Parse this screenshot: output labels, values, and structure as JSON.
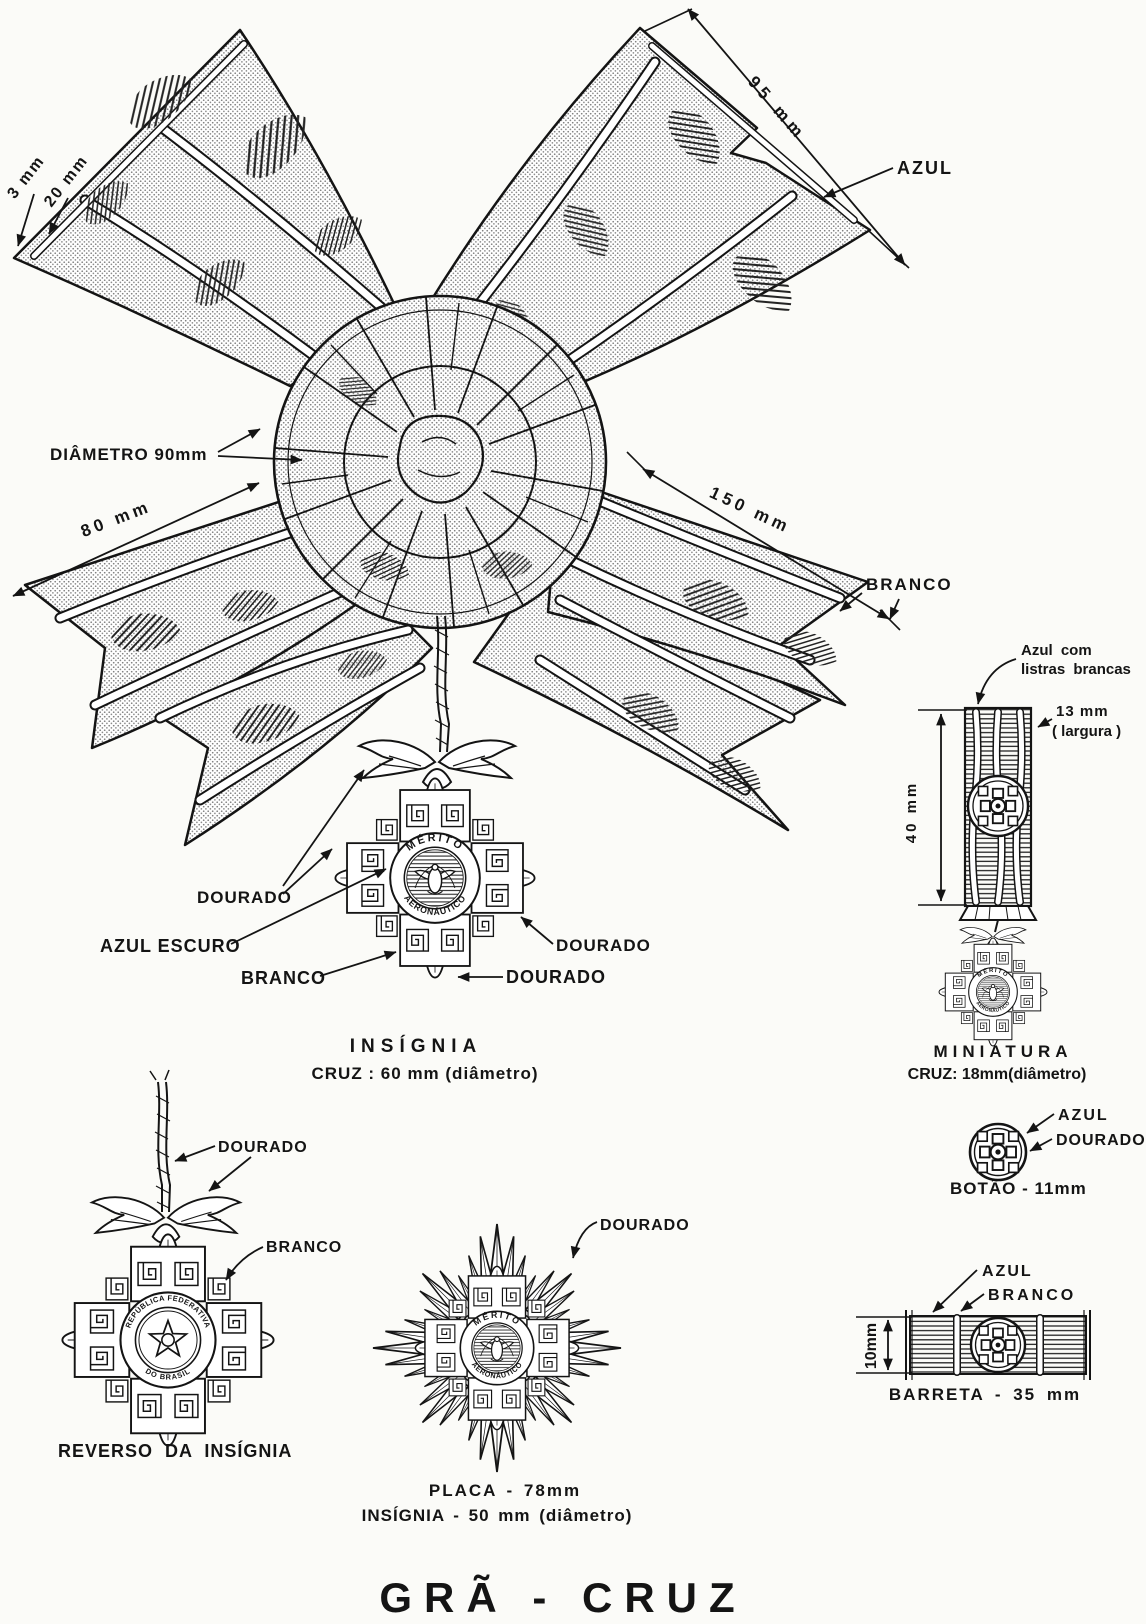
{
  "colors": {
    "ink": "#141414",
    "paper": "#fbfbf8"
  },
  "title": "GRÃ - CRUZ",
  "bow": {
    "dim_edge": "3 mm",
    "dim_band": "20 mm",
    "dim_ribbon_width": "95 mm",
    "label_azul": "AZUL",
    "label_diametro": "DIÂMETRO 90mm",
    "dim_tail_left": "80 mm",
    "dim_tail_right": "150 mm",
    "label_branco": "BRANCO"
  },
  "insignia": {
    "label_dourado_arms": "DOURADO",
    "label_azul_escuro": "AZUL ESCURO",
    "label_branco": "BRANCO",
    "label_dourado_right": "DOURADO",
    "label_dourado_propeller": "DOURADO",
    "caption": "INSÍGNIA",
    "caption_size": "CRUZ :  60 mm (diâmetro)",
    "ring_top": "MÉRITO",
    "ring_bottom": "AERONÁUTICO"
  },
  "miniatura": {
    "ribbon_label_line1": "Azul com",
    "ribbon_label_line2": "listras brancas",
    "dim_width_value": "13 mm",
    "dim_width_unit": "( largura )",
    "dim_height": "40 mm",
    "caption": "MINIATURA",
    "caption_size": "CRUZ: 18mm(diâmetro)"
  },
  "botao": {
    "label_azul": "AZUL",
    "label_dourado": "DOURADO",
    "caption": "BOTÃO - 11mm"
  },
  "reverso": {
    "label_dourado": "DOURADO",
    "label_branco": "BRANCO",
    "caption": "REVERSO DA INSÍGNIA",
    "ring_top": "REPÚBLICA FEDERATIVA",
    "ring_bottom": "DO BRASIL"
  },
  "placa": {
    "label_dourado": "DOURADO",
    "caption_line1": "PLACA - 78mm",
    "caption_line2": "INSÍGNIA - 50 mm (diâmetro)"
  },
  "barreta": {
    "label_azul": "AZUL",
    "label_branco": "BRANCO",
    "dim_height": "10mm",
    "caption": "BARRETA - 35 mm"
  }
}
